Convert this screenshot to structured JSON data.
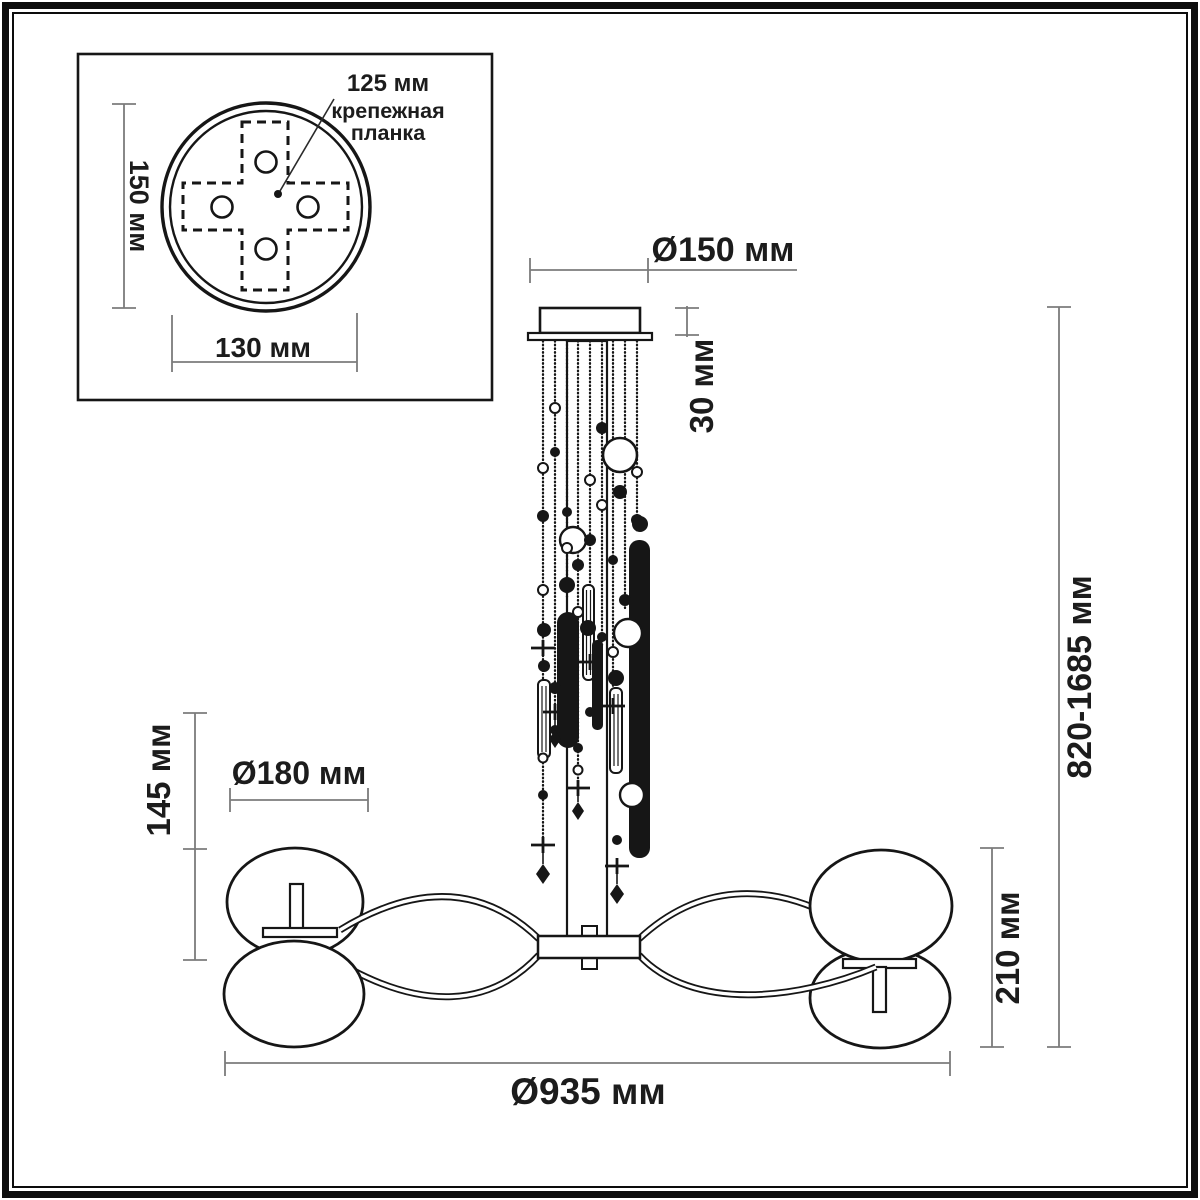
{
  "inset": {
    "pitch_label": "125 мм",
    "bracket_label_line1": "крепежная",
    "bracket_label_line2": "планка",
    "height_label": "150 мм",
    "width_label": "130 мм"
  },
  "dimensions": {
    "canopy_diameter": "Ø150 мм",
    "canopy_height": "30 мм",
    "overall_height": "820-1685 мм",
    "shade_unit_height": "145 мм",
    "shade_diameter": "Ø180 мм",
    "body_height": "210 мм",
    "overall_diameter": "Ø935 мм"
  },
  "colors": {
    "ink": "#161616",
    "dimension_lines": "#7b7b7b",
    "background": "#ffffff"
  }
}
